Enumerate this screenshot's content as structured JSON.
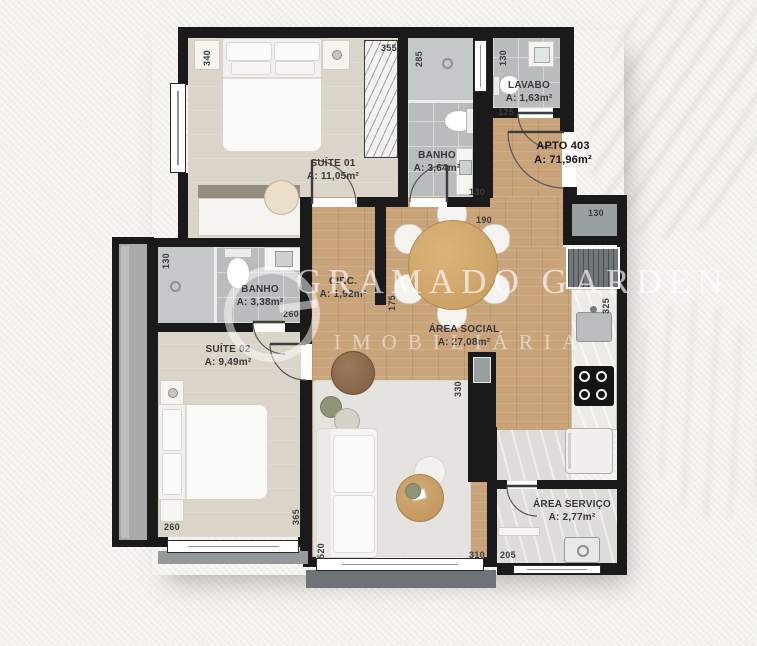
{
  "apartment": {
    "label": "APTO 403",
    "area": "A: 71,96m²"
  },
  "rooms": {
    "suite01": {
      "name": "SUÍTE 01",
      "area": "A: 11,05m²"
    },
    "banho1": {
      "name": "BANHO",
      "area": "A: 3,64m²"
    },
    "lavabo": {
      "name": "LAVABO",
      "area": "A: 1,63m²"
    },
    "banho2": {
      "name": "BANHO",
      "area": "A: 3,38m²"
    },
    "circ": {
      "name": "CIRC.",
      "area": "A: 1,92m²"
    },
    "suite02": {
      "name": "SUÍTE 02",
      "area": "A: 9,49m²"
    },
    "social": {
      "name": "ÁREA SOCIAL",
      "area": "A: 27,08m²"
    },
    "servico": {
      "name": "ÁREA SERVIÇO",
      "area": "A: 2,77m²"
    }
  },
  "watermark": {
    "line1": "GRAMADO GARDEN",
    "line2": "IMOBILIÁRIA",
    "logo": "g-ring-logo"
  },
  "dimensions": [
    {
      "v": "340",
      "x": 207,
      "y": 58,
      "o": "v"
    },
    {
      "v": "355",
      "x": 389,
      "y": 48,
      "o": "h"
    },
    {
      "v": "285",
      "x": 419,
      "y": 59,
      "o": "v"
    },
    {
      "v": "130",
      "x": 503,
      "y": 58,
      "o": "v"
    },
    {
      "v": "125",
      "x": 506,
      "y": 112,
      "o": "h"
    },
    {
      "v": "130",
      "x": 477,
      "y": 192,
      "o": "h"
    },
    {
      "v": "190",
      "x": 484,
      "y": 220,
      "o": "h"
    },
    {
      "v": "130",
      "x": 596,
      "y": 213,
      "o": "h"
    },
    {
      "v": "325",
      "x": 606,
      "y": 306,
      "o": "v"
    },
    {
      "v": "130",
      "x": 166,
      "y": 261,
      "o": "v"
    },
    {
      "v": "260",
      "x": 291,
      "y": 314,
      "o": "h"
    },
    {
      "v": "175",
      "x": 392,
      "y": 303,
      "o": "v"
    },
    {
      "v": "330",
      "x": 458,
      "y": 389,
      "o": "v"
    },
    {
      "v": "260",
      "x": 172,
      "y": 527,
      "o": "h"
    },
    {
      "v": "365",
      "x": 296,
      "y": 517,
      "o": "v"
    },
    {
      "v": "520",
      "x": 321,
      "y": 551,
      "o": "v"
    },
    {
      "v": "310",
      "x": 477,
      "y": 555,
      "o": "h"
    },
    {
      "v": "205",
      "x": 508,
      "y": 555,
      "o": "h"
    }
  ],
  "colors": {
    "wall": "#1a1a1a",
    "wood": "#c9a37a",
    "bedroom": "#dbd4c8",
    "tile": "#b9bcbd",
    "marble": "#dddcd8",
    "rug": "#e5e3df",
    "furniture": "#f5f4f1",
    "sill": "#6d7377",
    "table_wood": "#d2a96d",
    "pouf_brown": "#8a6a4e"
  }
}
